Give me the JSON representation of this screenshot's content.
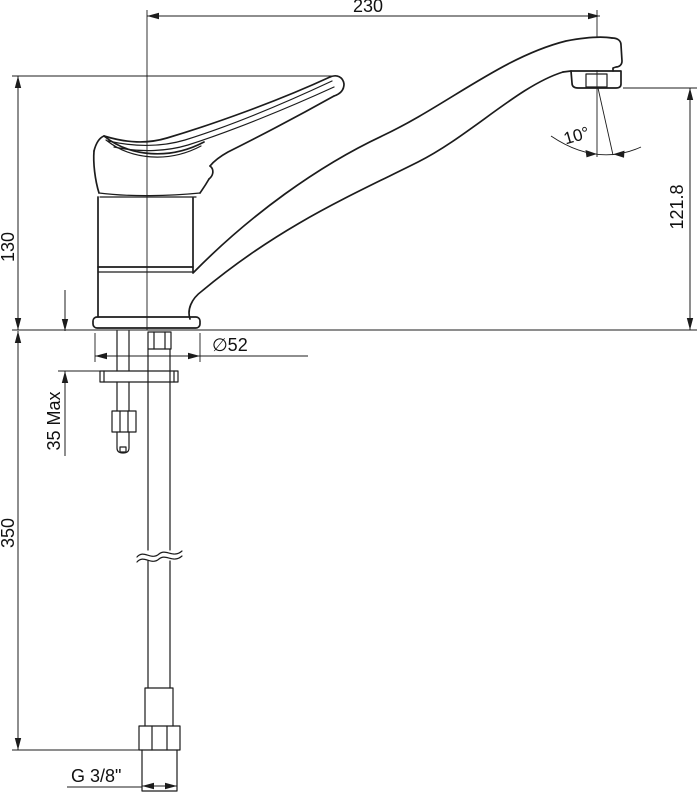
{
  "drawing": {
    "dimensions": {
      "spout_reach": "230",
      "height_to_handle_top": "130",
      "spout_outlet_height": "121.8",
      "spout_end_angle": "10°",
      "base_diameter": "∅52",
      "max_mounting_thickness": "35 Max",
      "supply_pipe_length": "350",
      "connection_thread": "G 3/8\""
    },
    "colors": {
      "line": "#1c1c1c",
      "background": "#ffffff"
    }
  }
}
